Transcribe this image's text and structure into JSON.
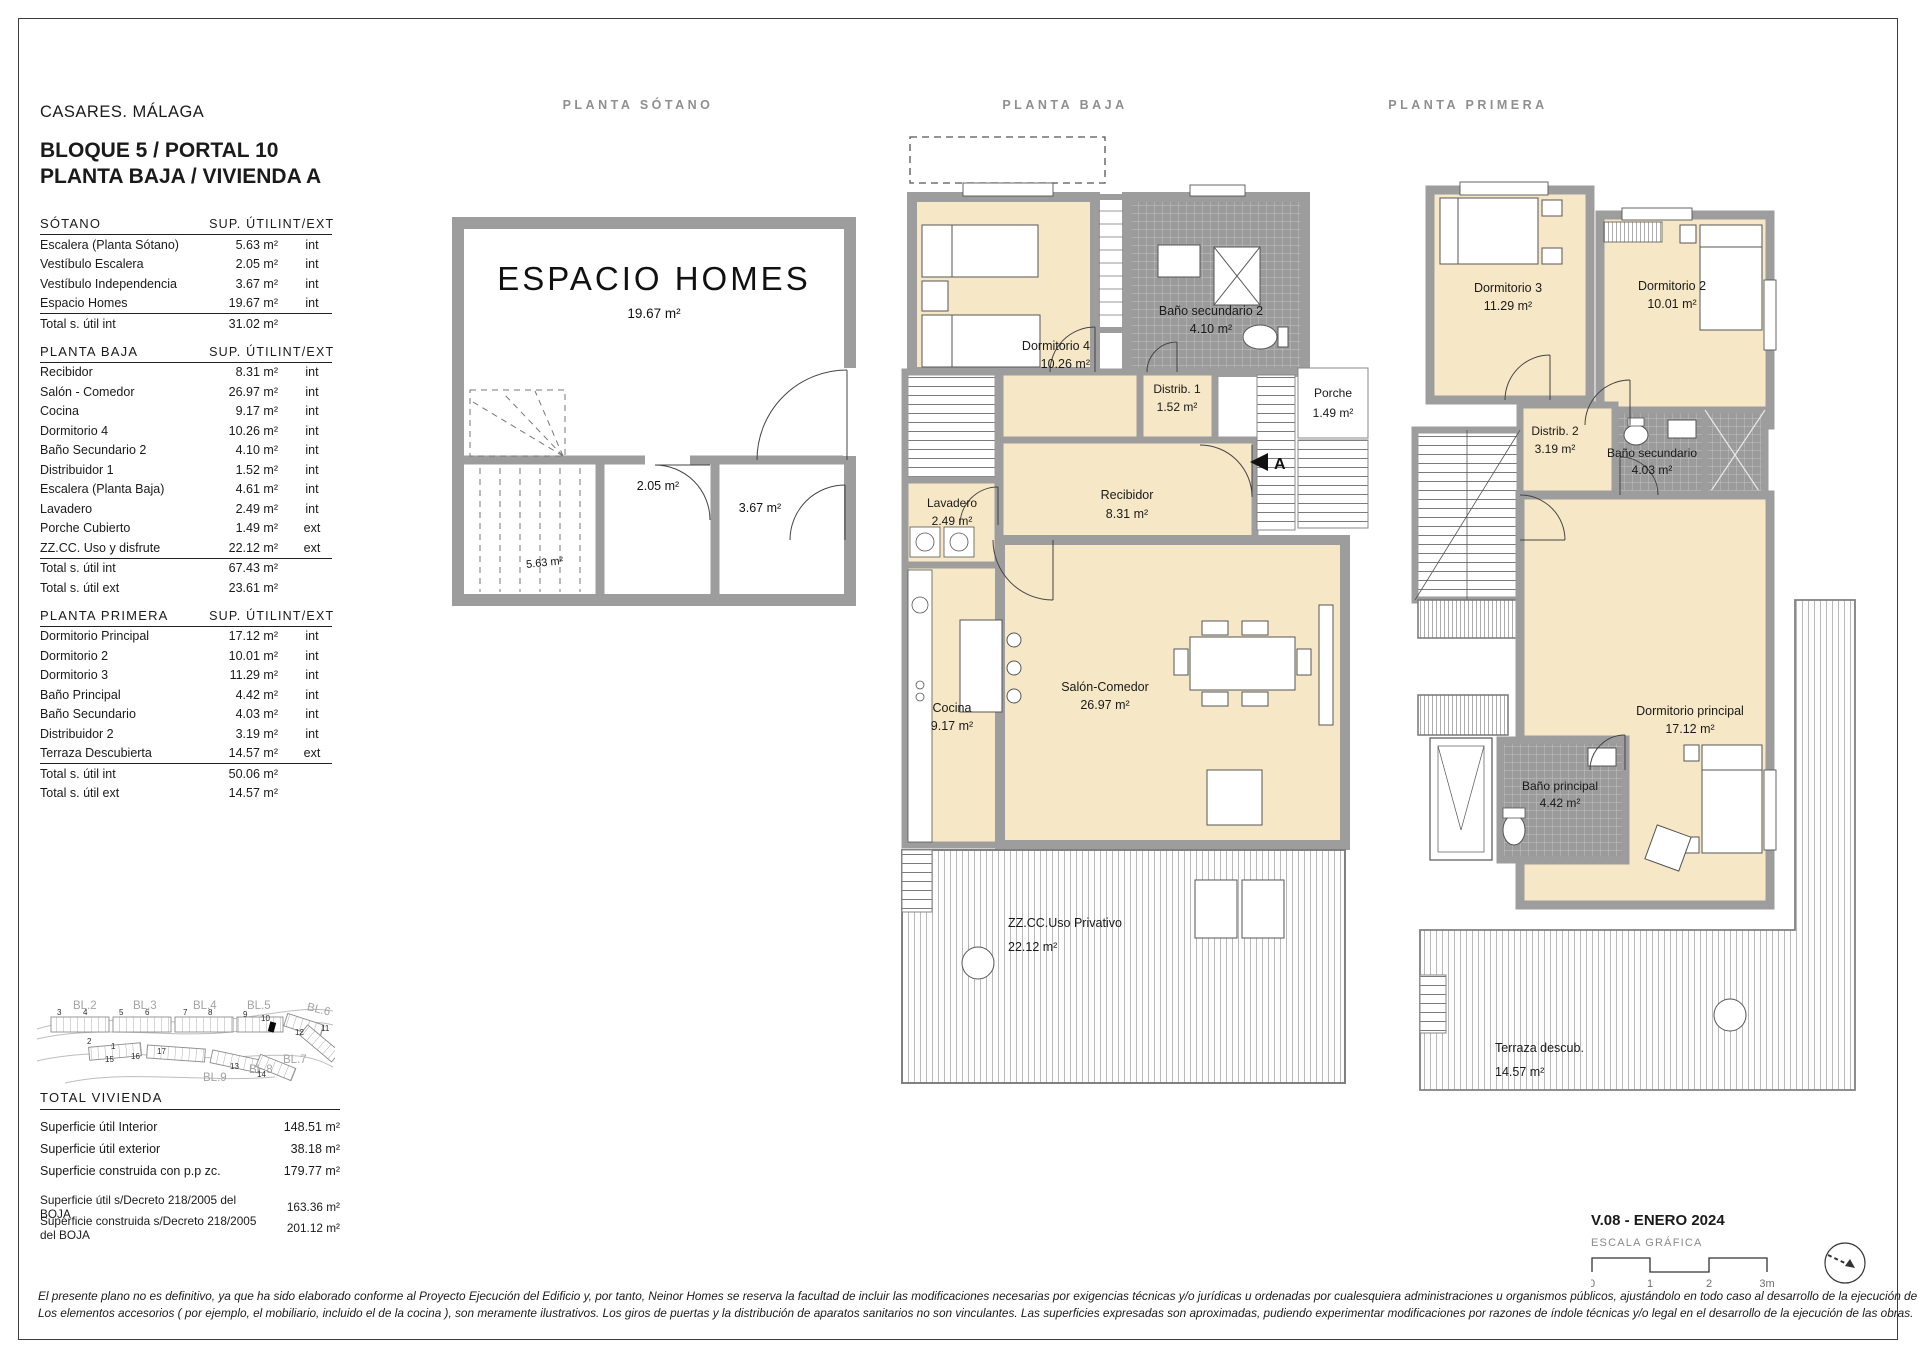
{
  "header": {
    "location": "CASARES. MÁLAGA",
    "line1": "BLOQUE 5 / PORTAL 10",
    "line2": "PLANTA BAJA / VIVIENDA A"
  },
  "table": {
    "sections": [
      {
        "title": "SÓTANO",
        "col_area": "SUP. ÚTIL",
        "col_intext": "INT/EXT",
        "rows": [
          {
            "name": "Escalera (Planta Sótano)",
            "area": "5.63 m²",
            "type": "int"
          },
          {
            "name": "Vestíbulo Escalera",
            "area": "2.05 m²",
            "type": "int"
          },
          {
            "name": "Vestíbulo Independencia",
            "area": "3.67 m²",
            "type": "int"
          },
          {
            "name": "Espacio Homes",
            "area": "19.67 m²",
            "type": "int"
          }
        ],
        "totals": [
          {
            "name": "Total s. útil int",
            "area": "31.02 m²"
          }
        ]
      },
      {
        "title": "PLANTA BAJA",
        "col_area": "SUP. ÚTIL",
        "col_intext": "INT/EXT",
        "rows": [
          {
            "name": "Recibidor",
            "area": "8.31 m²",
            "type": "int"
          },
          {
            "name": "Salón - Comedor",
            "area": "26.97 m²",
            "type": "int"
          },
          {
            "name": "Cocina",
            "area": "9.17 m²",
            "type": "int"
          },
          {
            "name": "Dormitorio 4",
            "area": "10.26 m²",
            "type": "int"
          },
          {
            "name": "Baño Secundario 2",
            "area": "4.10 m²",
            "type": "int"
          },
          {
            "name": "Distribuidor 1",
            "area": "1.52 m²",
            "type": "int"
          },
          {
            "name": "Escalera (Planta Baja)",
            "area": "4.61 m²",
            "type": "int"
          },
          {
            "name": "Lavadero",
            "area": "2.49 m²",
            "type": "int"
          },
          {
            "name": "Porche Cubierto",
            "area": "1.49 m²",
            "type": "ext"
          },
          {
            "name": "ZZ.CC. Uso y disfrute",
            "area": "22.12 m²",
            "type": "ext"
          }
        ],
        "totals": [
          {
            "name": "Total s. útil int",
            "area": "67.43 m²"
          },
          {
            "name": "Total s. útil ext",
            "area": "23.61 m²"
          }
        ]
      },
      {
        "title": "PLANTA PRIMERA",
        "col_area": "SUP. ÚTIL",
        "col_intext": "INT/EXT",
        "rows": [
          {
            "name": "Dormitorio Principal",
            "area": "17.12 m²",
            "type": "int"
          },
          {
            "name": "Dormitorio 2",
            "area": "10.01 m²",
            "type": "int"
          },
          {
            "name": "Dormitorio 3",
            "area": "11.29 m²",
            "type": "int"
          },
          {
            "name": "Baño Principal",
            "area": "4.42 m²",
            "type": "int"
          },
          {
            "name": "Baño Secundario",
            "area": "4.03 m²",
            "type": "int"
          },
          {
            "name": "Distribuidor 2",
            "area": "3.19 m²",
            "type": "int"
          },
          {
            "name": "Terraza Descubierta",
            "area": "14.57 m²",
            "type": "ext"
          }
        ],
        "totals": [
          {
            "name": "Total s. útil int",
            "area": "50.06 m²"
          },
          {
            "name": "Total s. útil ext",
            "area": "14.57 m²"
          }
        ]
      }
    ]
  },
  "site_map": {
    "blocks": [
      "BL.2",
      "BL.3",
      "BL.4",
      "BL.5",
      "BL.6",
      "BL.7",
      "BL.8",
      "BL.9"
    ],
    "units": [
      "1",
      "2",
      "3",
      "4",
      "5",
      "6",
      "7",
      "8",
      "9",
      "10",
      "11",
      "12",
      "13",
      "14",
      "15",
      "16",
      "17"
    ]
  },
  "totals_block": {
    "title": "TOTAL VIVIENDA",
    "rows": [
      {
        "name": "Superficie útil Interior",
        "area": "148.51 m²"
      },
      {
        "name": "Superficie útil exterior",
        "area": "38.18 m²"
      },
      {
        "name": "Superficie construida con p.p zc.",
        "area": "179.77 m²"
      }
    ],
    "decree_rows": [
      {
        "name": "Superficie útil s/Decreto 218/2005 del BOJA",
        "area": "163.36 m²"
      },
      {
        "name": "Superficie construida s/Decreto 218/2005 del BOJA",
        "area": "201.12 m²"
      }
    ]
  },
  "plans": {
    "sotano": {
      "title": "PLANTA SÓTANO",
      "room_name": "ESPACIO HOMES",
      "room_area": "19.67 m²",
      "vestibulo_escalera_area": "2.05 m²",
      "vestibulo_independencia_area": "3.67 m²",
      "escalera_area": "5.63 m²"
    },
    "baja": {
      "title": "PLANTA BAJA",
      "dormitorio4": {
        "name": "Dormitorio 4",
        "area": "10.26 m²"
      },
      "bano2": {
        "name": "Baño secundario 2",
        "area": "4.10 m²"
      },
      "distrib1": {
        "name": "Distrib. 1",
        "area": "1.52 m²"
      },
      "porche": {
        "name": "Porche",
        "area": "1.49 m²"
      },
      "recibidor": {
        "name": "Recibidor",
        "area": "8.31 m²"
      },
      "lavadero": {
        "name": "Lavadero",
        "area": "2.49 m²"
      },
      "salon": {
        "name": "Salón-Comedor",
        "area": "26.97 m²"
      },
      "cocina": {
        "name": "Cocina",
        "area": "9.17 m²"
      },
      "terraza": {
        "name": "ZZ.CC.Uso Privativo",
        "area": "22.12 m²"
      },
      "section_marker": "A"
    },
    "primera": {
      "title": "PLANTA PRIMERA",
      "dorm3": {
        "name": "Dormitorio 3",
        "area": "11.29 m²"
      },
      "dorm2": {
        "name": "Dormitorio 2",
        "area": "10.01 m²"
      },
      "distrib2": {
        "name": "Distrib. 2",
        "area": "3.19 m²"
      },
      "banosec": {
        "name": "Baño secundario",
        "area": "4.03 m²"
      },
      "dormppal": {
        "name": "Dormitorio principal",
        "area": "17.12 m²"
      },
      "banoppal": {
        "name": "Baño principal",
        "area": "4.42 m²"
      },
      "terraza": {
        "name": "Terraza descub.",
        "area": "14.57 m²"
      }
    }
  },
  "footer": {
    "version": "V.08 - ENERO 2024",
    "scale_label": "ESCALA GRÁFICA",
    "ticks": [
      "0",
      "1",
      "2",
      "3m"
    ],
    "legal1": "El presente plano no es definitivo, ya que ha sido elaborado conforme al Proyecto Ejecución del Edificio y, por tanto, Neinor Homes se reserva la facultad de incluir las modificaciones necesarias por exigencias técnicas y/o jurídicas u ordenadas por cualesquiera administraciones u organismos públicos, ajustándolo en todo caso al desarrollo de la ejecución de las obras.",
    "legal2": "Los elementos accesorios  ( por ejemplo, el mobiliario, incluido el de la cocina ),  son meramente ilustrativos.  Los giros de puertas  y  la distribución de aparatos sanitarios no son vinculantes.  Las superficies  expresadas son aproximadas,  pudiendo  experimentar modificaciones por razones de índole técnicas y/o legal en el desarrollo de la ejecución de las obras."
  },
  "colors": {
    "wall": "#9d9d9d",
    "room_fill": "#f6e8c6",
    "tile_fill": "#9b9b9b",
    "label_gray": "#8f8f8f"
  }
}
